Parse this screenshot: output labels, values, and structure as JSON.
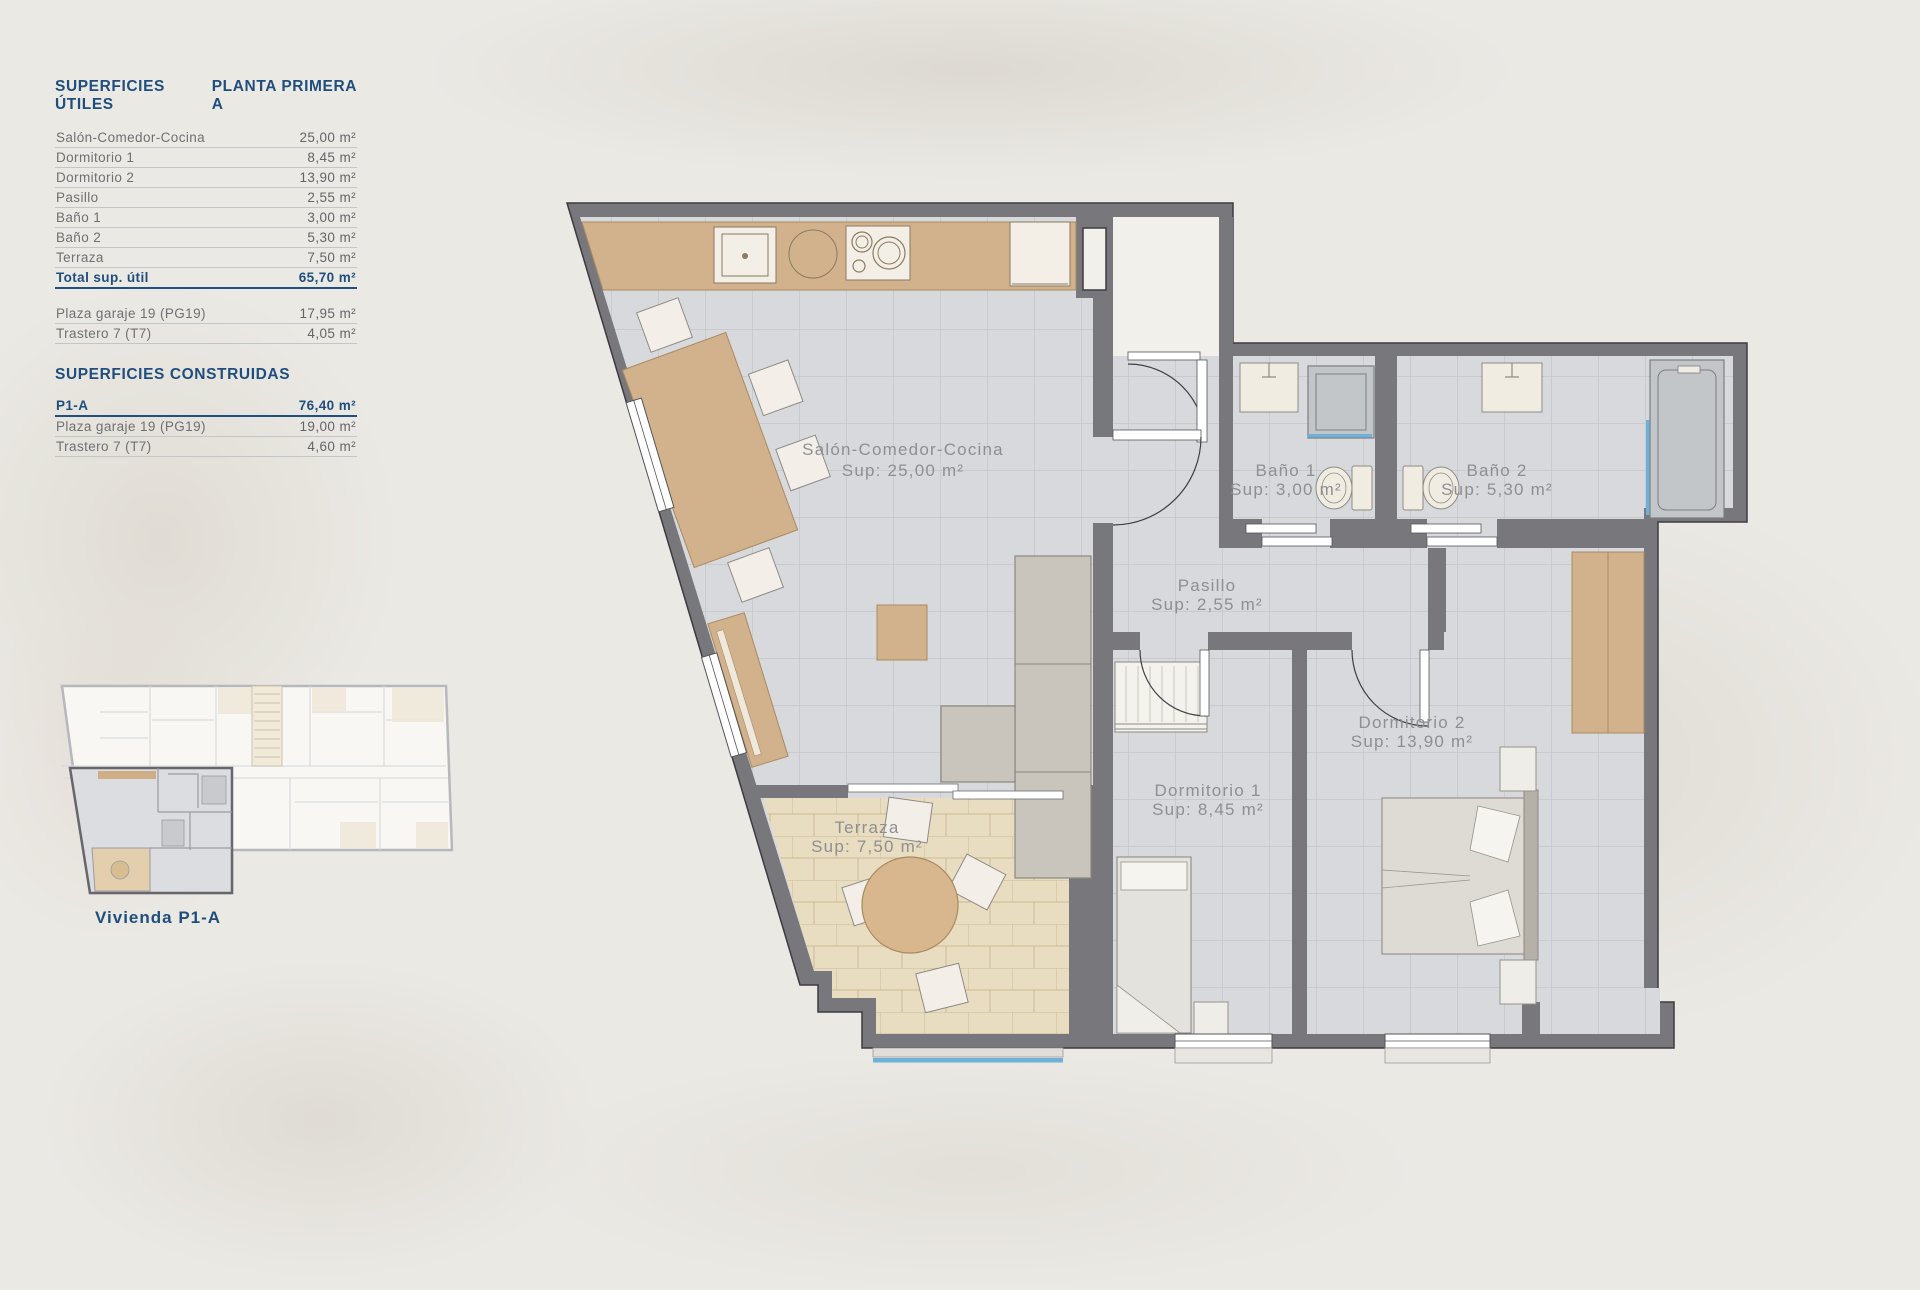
{
  "colors": {
    "accent_navy": "#1f4e7e",
    "wall_gray": "#77777c",
    "label_gray": "#8f8f91",
    "wood": "#d2b28c",
    "terrace_tile": "#e8ddc1",
    "floor_tile": "#d7d9dc",
    "glass_blue": "#6fb0d8"
  },
  "panel": {
    "utiles": {
      "title": "SUPERFICIES ÚTILES",
      "plant": "PLANTA PRIMERA A",
      "rows": [
        {
          "label": "Salón-Comedor-Cocina",
          "value": "25,00 m²"
        },
        {
          "label": "Dormitorio 1",
          "value": "8,45 m²"
        },
        {
          "label": "Dormitorio 2",
          "value": "13,90 m²"
        },
        {
          "label": "Pasillo",
          "value": "2,55 m²"
        },
        {
          "label": "Baño 1",
          "value": "3,00 m²"
        },
        {
          "label": "Baño 2",
          "value": "5,30 m²"
        },
        {
          "label": "Terraza",
          "value": "7,50 m²"
        }
      ],
      "total": {
        "label": "Total sup. útil",
        "value": "65,70 m²"
      },
      "annex": [
        {
          "label": "Plaza garaje 19 (PG19)",
          "value": "17,95 m²"
        },
        {
          "label": "Trastero 7 (T7)",
          "value": "4,05 m²"
        }
      ]
    },
    "construidas": {
      "title": "SUPERFICIES CONSTRUIDAS",
      "rows": [
        {
          "label": "P1-A",
          "value": "76,40 m²"
        },
        {
          "label": "Plaza garaje 19 (PG19)",
          "value": "19,00 m²"
        },
        {
          "label": "Trastero 7 (T7)",
          "value": "4,60 m²"
        }
      ]
    }
  },
  "mini_plan": {
    "caption": "Vivienda P1-A"
  },
  "plan": {
    "rooms": [
      {
        "name": "Salón-Comedor-Cocina",
        "sup": "Sup: 25,00 m²"
      },
      {
        "name": "Baño 1",
        "sup": "Sup: 3,00 m²"
      },
      {
        "name": "Baño 2",
        "sup": "Sup: 5,30 m²"
      },
      {
        "name": "Pasillo",
        "sup": "Sup: 2,55 m²"
      },
      {
        "name": "Dormitorio 2",
        "sup": "Sup: 13,90 m²"
      },
      {
        "name": "Dormitorio 1",
        "sup": "Sup: 8,45 m²"
      },
      {
        "name": "Terraza",
        "sup": "Sup: 7,50 m²"
      }
    ]
  }
}
